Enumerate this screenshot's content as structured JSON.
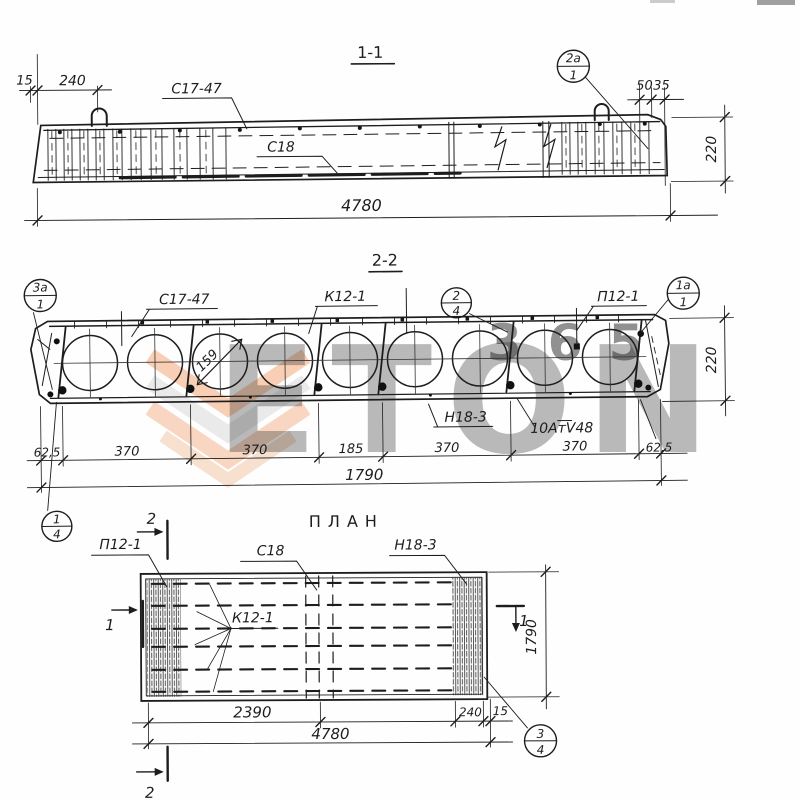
{
  "watermark": {
    "brand": "ETON",
    "number": "365",
    "orange": "#ee8040",
    "gray": "#c9c9c9"
  },
  "ink": "#1d1d1d",
  "s11": {
    "title": "1-1",
    "mesh_top": "С17-47",
    "mesh_bot": "С18",
    "callout_top": "2а",
    "callout_bot": "1",
    "d15": "15",
    "d240": "240",
    "d50": "50",
    "d35": "35",
    "d220": "220",
    "d4780": "4780"
  },
  "s22": {
    "title": "2-2",
    "mesh": "С17-47",
    "frame": "К12-1",
    "panel": "П12-1",
    "mesh_n": "Н18-3",
    "strand": "10АтV48",
    "dia": "159",
    "d220": "220",
    "chain": [
      "62,5",
      "370",
      "370",
      "185",
      "370",
      "370",
      "62,5"
    ],
    "total": "1790",
    "c3a_top": "3а",
    "c3a_bot": "1",
    "c2_top": "2",
    "c2_bot": "4",
    "c1a_top": "1а",
    "c1a_bot": "1",
    "c14_top": "1",
    "c14_bot": "4"
  },
  "plan": {
    "title": "ПЛАН",
    "panel": "П12-1",
    "mesh_c": "С18",
    "mesh_n": "Н18-3",
    "frame": "К12-1",
    "m2": "2",
    "m1": "1",
    "d2390": "2390",
    "d4780": "4780",
    "d240": "240",
    "d15": "15",
    "d1790": "1790",
    "c34_top": "3",
    "c34_bot": "4"
  }
}
